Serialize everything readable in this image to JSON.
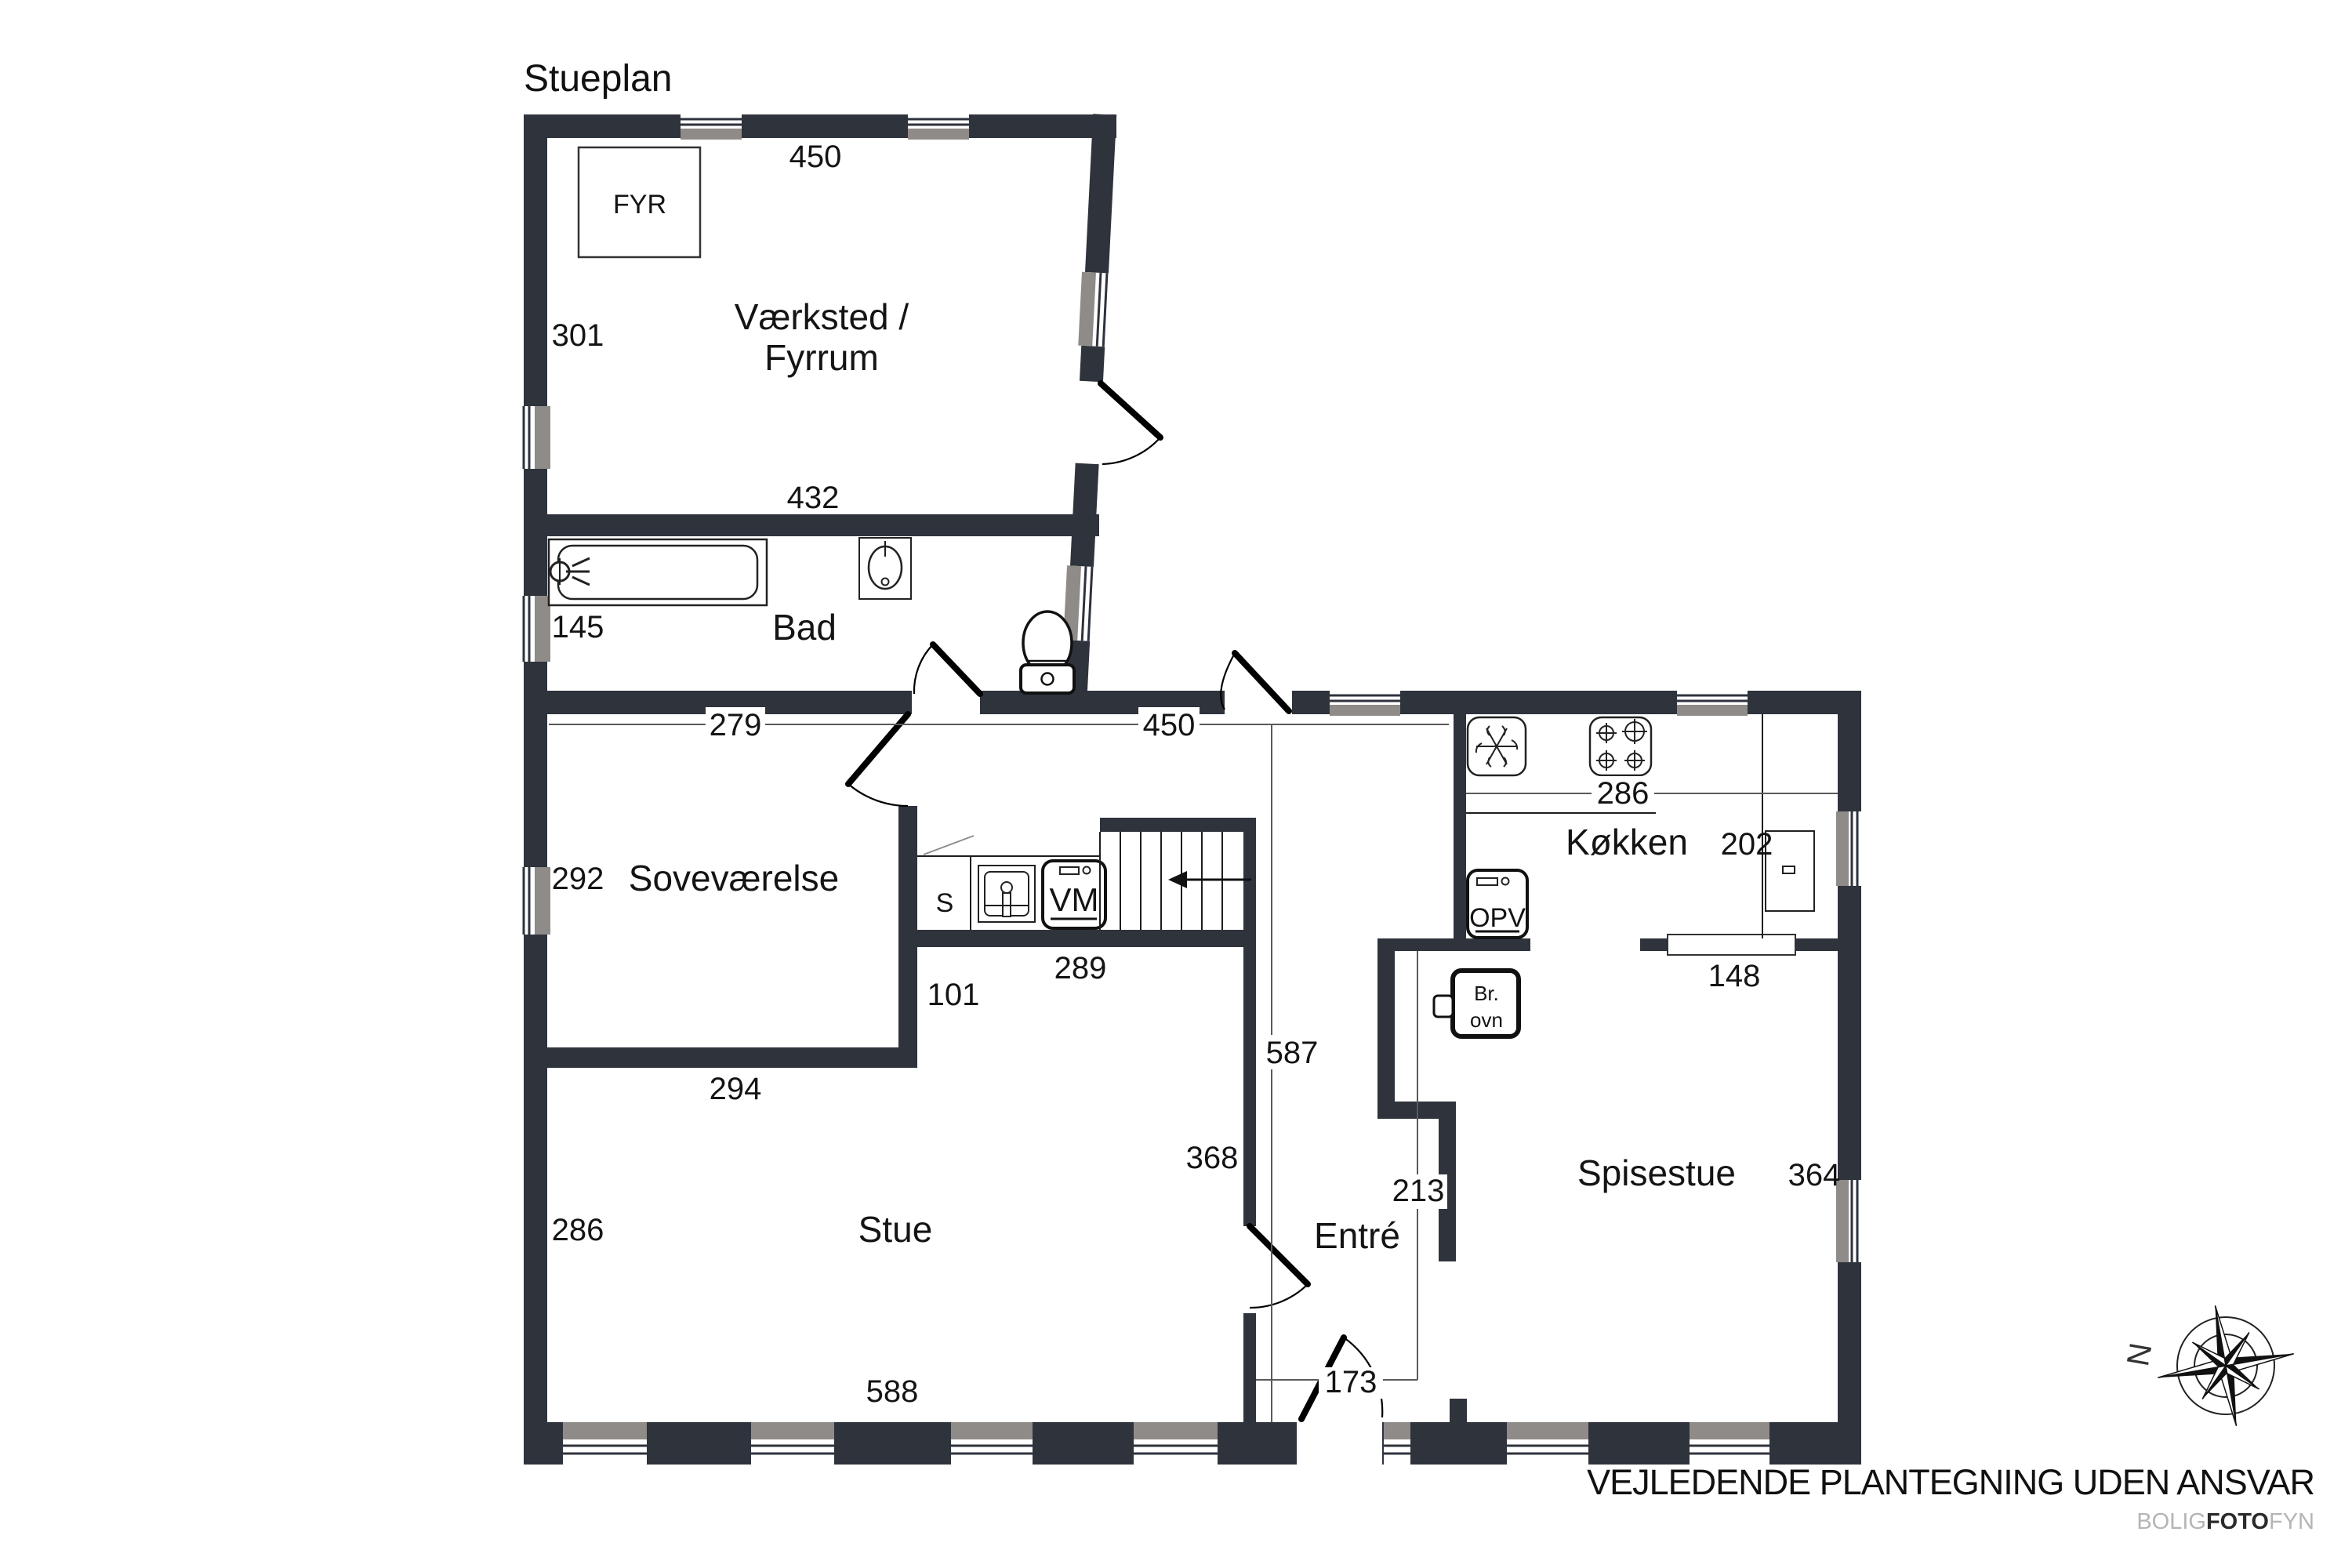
{
  "title": "Stueplan",
  "rooms": {
    "vaerksted_line1": "Værksted /",
    "vaerksted_line2": "Fyrrum",
    "bad": "Bad",
    "sovevaerelse": "Soveværelse",
    "stue": "Stue",
    "entre": "Entré",
    "koekken": "Køkken",
    "spisestue": "Spisestue"
  },
  "fixtures": {
    "boiler": "FYR",
    "sink_small": "S",
    "washing_machine": "VM",
    "dishwasher": "OPV",
    "wood_stove_line1": "Br.",
    "wood_stove_line2": "ovn"
  },
  "dimensions": {
    "vaerksted_top": "450",
    "vaerksted_left": "301",
    "vaerksted_bottom": "432",
    "bad_left": "145",
    "sovevaerelse_top": "279",
    "hall_width": "450",
    "sovevaerelse_left": "292",
    "sovevaerelse_bottom": "294",
    "stue_left": "286",
    "stue_bottom": "588",
    "inner_wall": "101",
    "counter": "289",
    "entre_height": "587",
    "stue_right": "368",
    "entrance": "173",
    "entre_width": "213",
    "koekken_width": "286",
    "koekken_right": "202",
    "koekken_opening": "148",
    "spisestue_right": "364"
  },
  "compass": {
    "north": "N"
  },
  "footer": {
    "disclaimer": "VEJLEDENDE PLANTEGNING UDEN ANSVAR",
    "logo_part1": "BOLIG",
    "logo_part2": "FOTO",
    "logo_part3": "FYN"
  },
  "colors": {
    "wall": "#2e333c",
    "window_gray": "#8f8b89",
    "text": "#141414"
  }
}
